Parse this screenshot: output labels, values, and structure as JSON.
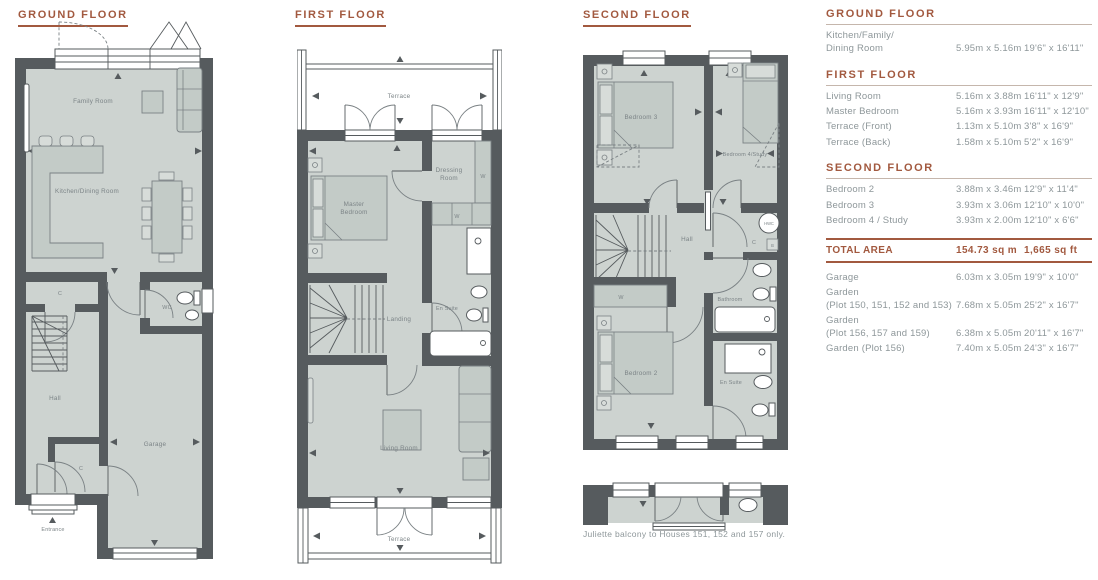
{
  "colors": {
    "accent": "#a2593f",
    "text_gray": "#8e979a",
    "wall": "#565b5e",
    "floor": "#cdd3d0"
  },
  "plans": [
    {
      "title": "GROUND FLOOR",
      "rooms": {
        "family": "Family Room",
        "kitchen": "Kitchen/Dining Room",
        "closet1": "C",
        "wc": "WC",
        "hall": "Hall",
        "closet2": "C",
        "garage": "Garage",
        "entrance": "Entrance"
      }
    },
    {
      "title": "FIRST FLOOR",
      "rooms": {
        "terrace_front": "Terrace",
        "master": [
          "Master",
          "Bedroom"
        ],
        "dressing": [
          "Dressing",
          "Room"
        ],
        "wardrobe1": "W",
        "wardrobe2": "W",
        "ensuite": "En Suite",
        "landing": "Landing",
        "living": "Living Room",
        "terrace_back": "Terrace"
      }
    },
    {
      "title": "SECOND FLOOR",
      "rooms": {
        "bedroom3": "Bedroom 3",
        "bedroom4": "Bedroom 4/Study",
        "hall": "Hall",
        "hwc": "HWC",
        "cupboard": "C",
        "boiler": "B",
        "bathroom": "Bathroom",
        "wardrobe": "W",
        "bedroom2": "Bedroom 2",
        "ensuite": "En Suite"
      },
      "note": "Juliette balcony to Houses 151, 152 and 157 only."
    }
  ],
  "table": {
    "sections": [
      {
        "heading": "GROUND FLOOR",
        "rows": [
          {
            "label": "Kitchen/Family/\nDining Room",
            "metric": "5.95m x 5.16m",
            "imperial": "19'6\" x 16'11\""
          }
        ]
      },
      {
        "heading": "FIRST FLOOR",
        "rows": [
          {
            "label": "Living Room",
            "metric": "5.16m x 3.88m",
            "imperial": "16'11\" x 12'9\""
          },
          {
            "label": "Master Bedroom",
            "metric": "5.16m x 3.93m",
            "imperial": "16'11\" x 12'10\""
          },
          {
            "label": "Terrace (Front)",
            "metric": "1.13m x 5.10m",
            "imperial": "3'8\" x 16'9\""
          },
          {
            "label": "Terrace (Back)",
            "metric": "1.58m x 5.10m",
            "imperial": "5'2\" x 16'9\""
          }
        ]
      },
      {
        "heading": "SECOND FLOOR",
        "rows": [
          {
            "label": "Bedroom 2",
            "metric": "3.88m x 3.46m",
            "imperial": "12'9\" x 11'4\""
          },
          {
            "label": "Bedroom 3",
            "metric": "3.93m x 3.06m",
            "imperial": "12'10\" x 10'0\""
          },
          {
            "label": "Bedroom 4 / Study",
            "metric": "3.93m x 2.00m",
            "imperial": "12'10\" x 6'6\""
          }
        ]
      }
    ],
    "total": {
      "label": "TOTAL AREA",
      "metric": "154.73 sq m",
      "imperial": "1,665 sq ft"
    },
    "extras": [
      {
        "label": "Garage",
        "metric": "6.03m x 3.05m",
        "imperial": "19'9\" x 10'0\""
      },
      {
        "label": "Garden\n(Plot 150, 151, 152 and 153)",
        "metric": "7.68m x 5.05m",
        "imperial": "25'2\" x 16'7\""
      },
      {
        "label": "Garden\n(Plot 156, 157 and 159)",
        "metric": "6.38m x 5.05m",
        "imperial": "20'11\" x 16'7\""
      },
      {
        "label": "Garden (Plot 156)",
        "metric": "7.40m x 5.05m",
        "imperial": "24'3\" x 16'7\""
      }
    ]
  }
}
